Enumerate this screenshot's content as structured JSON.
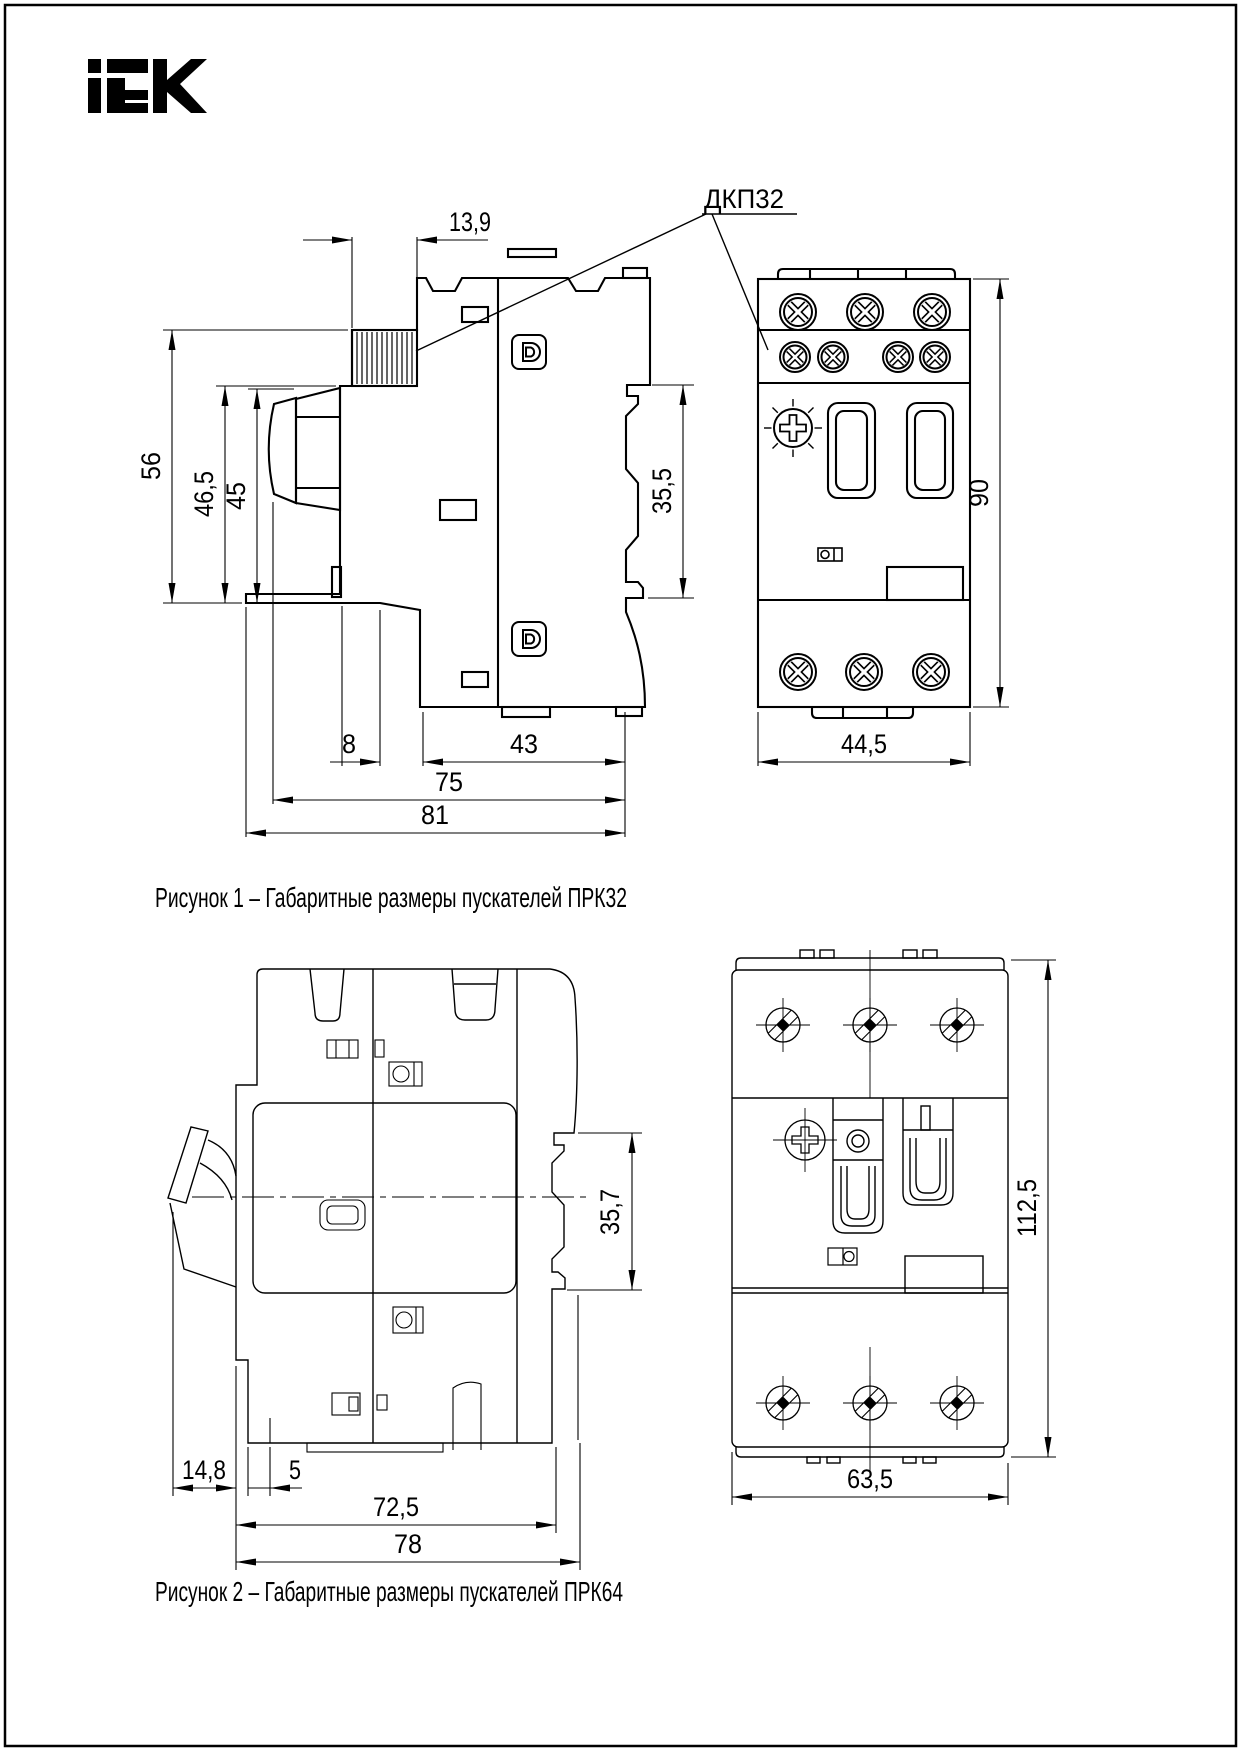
{
  "page": {
    "background": "#ffffff",
    "line_color": "#000000",
    "border_color": "#000000"
  },
  "logo": {
    "brand": "IEK"
  },
  "figure1": {
    "caption": "Рисунок 1 – Габаритные размеры пускателей ПРК32",
    "callout_label": "ДКП32",
    "side_view": {
      "dim_top_width": "13,9",
      "dim_height_total": "56",
      "dim_height_front": "46,5",
      "dim_height_knob": "45",
      "dim_din_rail": "35,5",
      "dim_offset_front": "8",
      "dim_depth_lower": "43",
      "dim_depth_body": "75",
      "dim_depth_total": "81"
    },
    "front_view": {
      "dim_width": "44,5",
      "dim_height": "90"
    }
  },
  "figure2": {
    "caption": "Рисунок 2 – Габаритные размеры  пускателей ПРК64",
    "side_view": {
      "dim_lever": "14,8",
      "dim_offset": "5",
      "dim_depth_body": "72,5",
      "dim_depth_total": "78",
      "dim_din_rail": "35,7"
    },
    "front_view": {
      "dim_width": "63,5",
      "dim_height": "112,5"
    }
  }
}
